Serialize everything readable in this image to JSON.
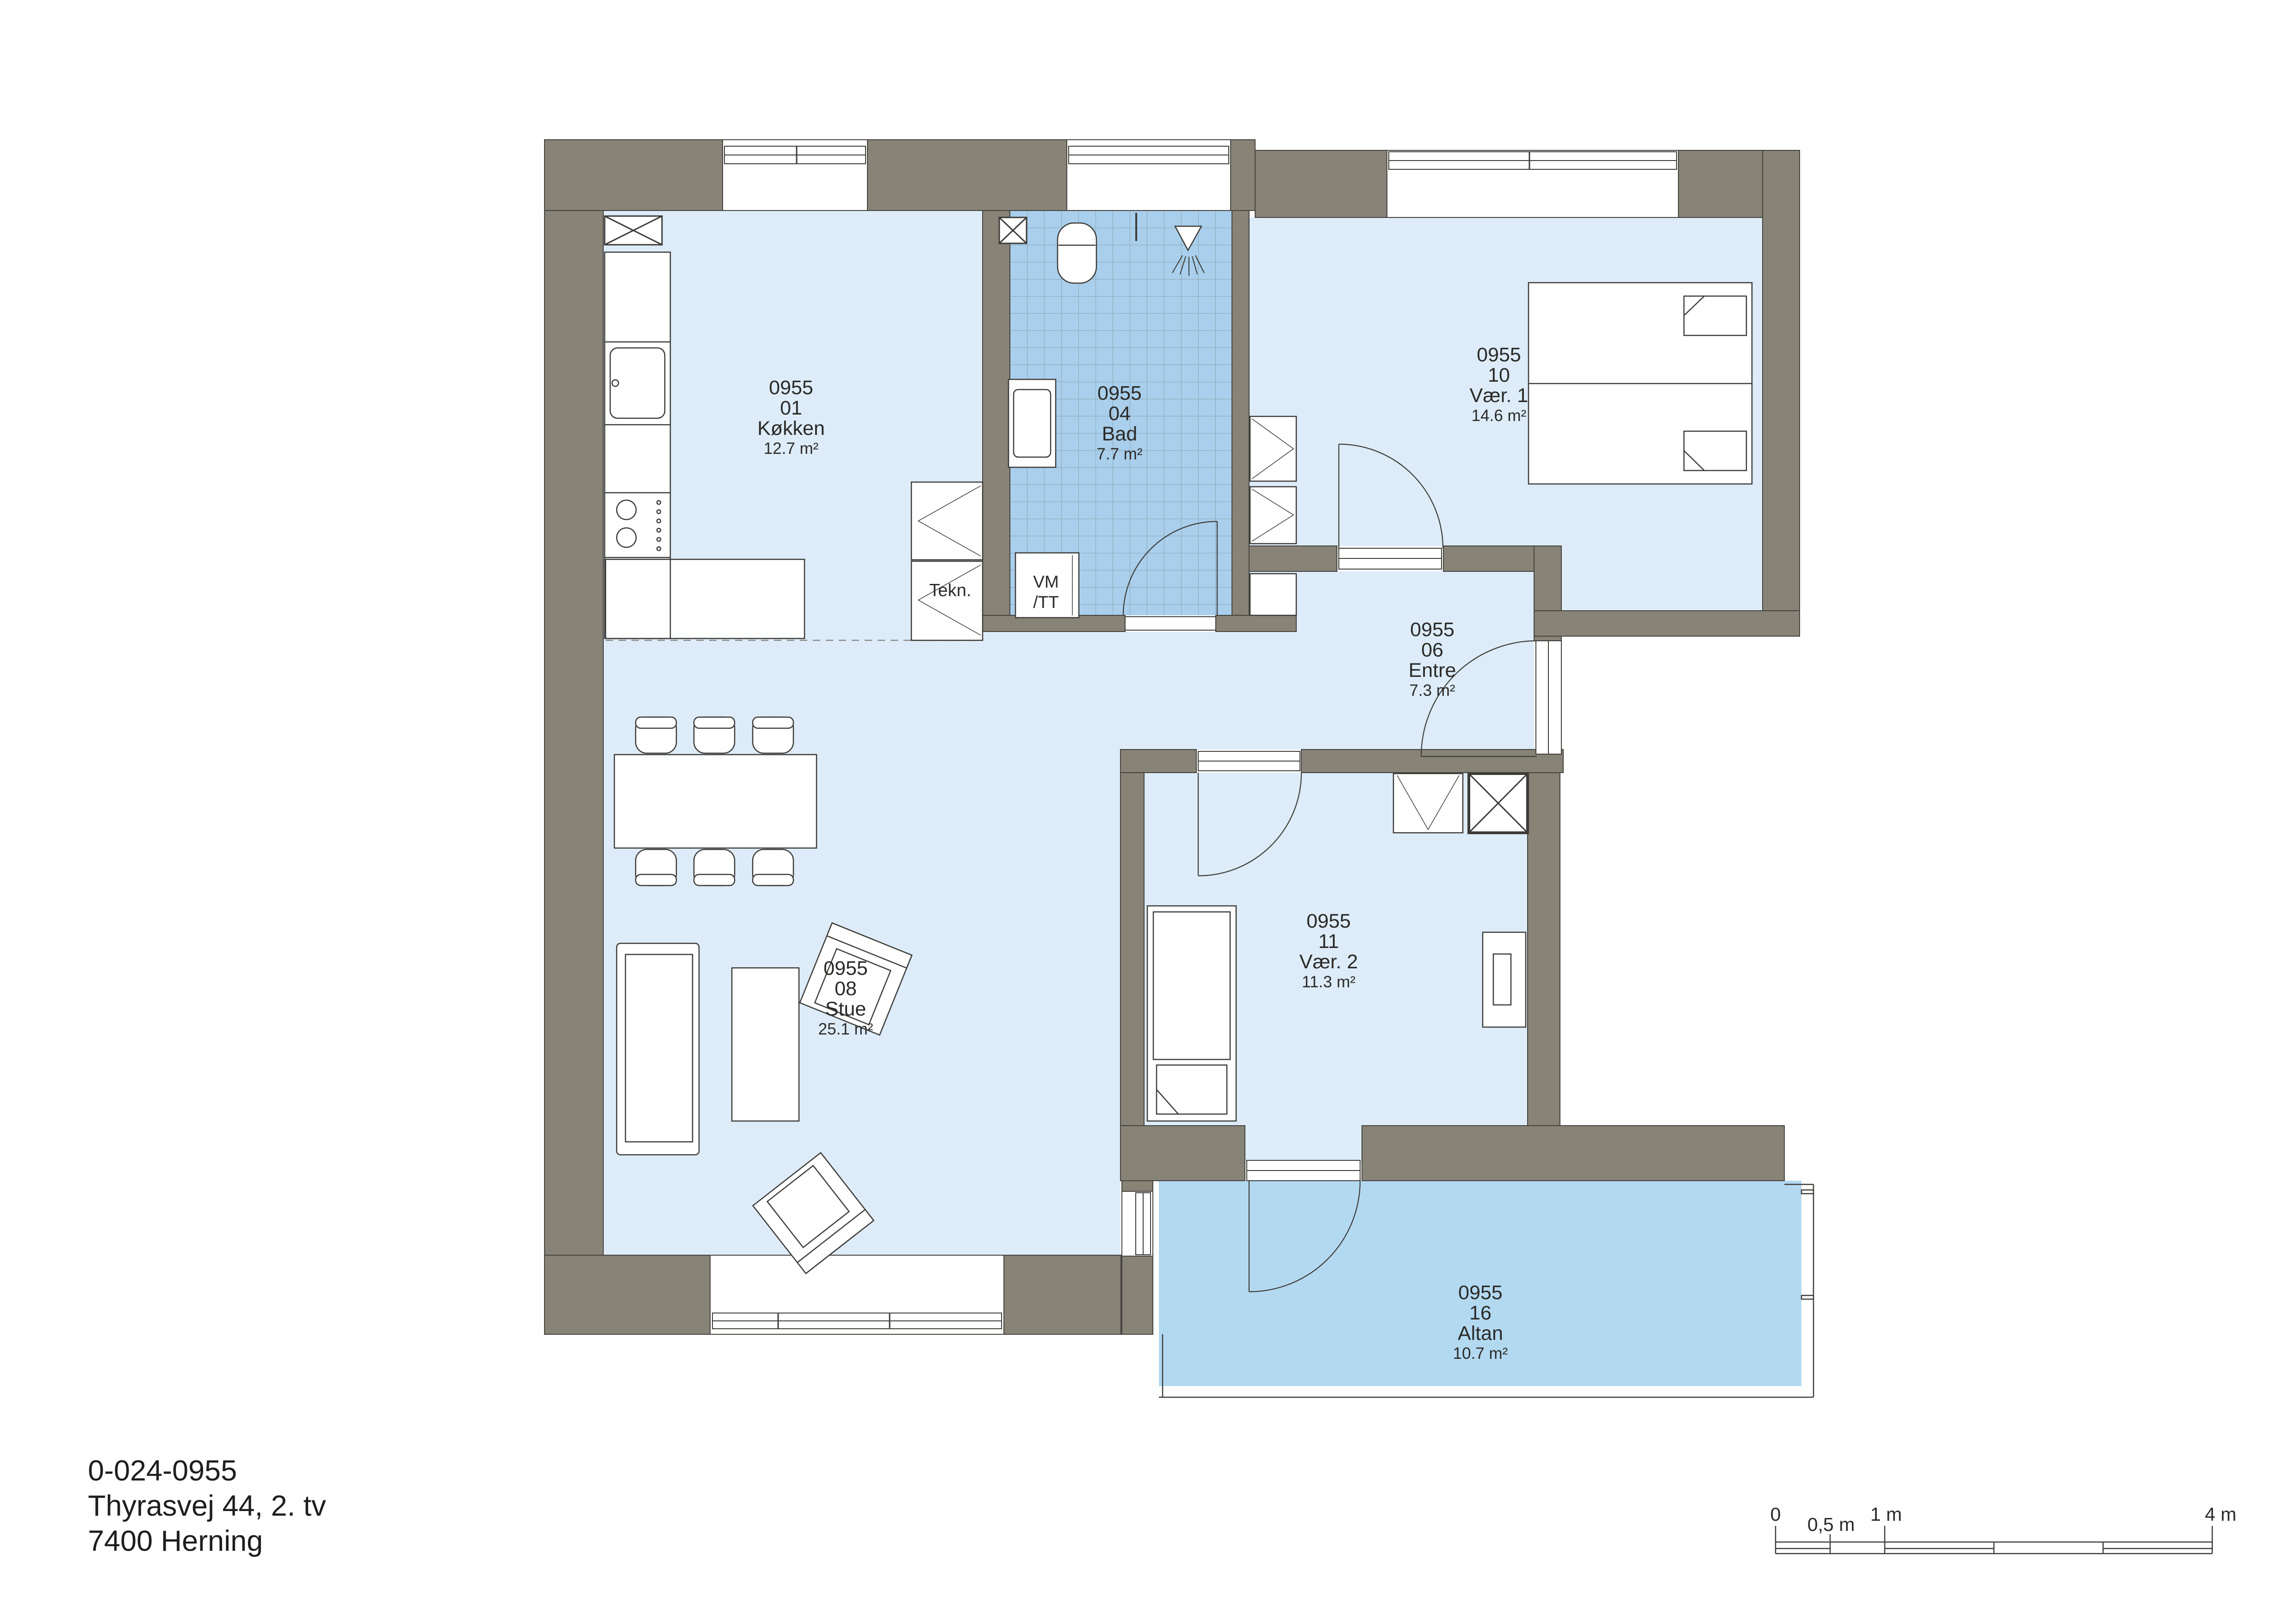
{
  "plan": {
    "rooms": [
      {
        "key": "kokken",
        "number": "0955",
        "unit": "01",
        "name": "Køkken",
        "area": "12.7 m²"
      },
      {
        "key": "bad",
        "number": "0955",
        "unit": "04",
        "name": "Bad",
        "area": "7.7 m²"
      },
      {
        "key": "var1",
        "number": "0955",
        "unit": "10",
        "name": "Vær. 1",
        "area": "14.6 m²"
      },
      {
        "key": "entre",
        "number": "0955",
        "unit": "06",
        "name": "Entre",
        "area": "7.3 m²"
      },
      {
        "key": "var2",
        "number": "0955",
        "unit": "11",
        "name": "Vær. 2",
        "area": "11.3 m²"
      },
      {
        "key": "stue",
        "number": "0955",
        "unit": "08",
        "name": "Stue",
        "area": "25.1 m²"
      },
      {
        "key": "altan",
        "number": "0955",
        "unit": "16",
        "name": "Altan",
        "area": "10.7 m²"
      }
    ],
    "annotations": {
      "tekn": "Tekn.",
      "vm": "VM",
      "tt": "/TT"
    }
  },
  "footer": {
    "plan_id": "0-024-0955",
    "address": "Thyrasvej 44, 2. tv",
    "city": "7400 Herning"
  },
  "scale_bar": {
    "ticks": [
      "0",
      "0,5 m",
      "1 m",
      "4 m"
    ]
  },
  "colors": {
    "wall": "#878377",
    "room_fill": "#ddecf8",
    "tile_fill": "#a9cfec",
    "balcony_fill": "#b3d9f1",
    "line": "#3e3c38"
  }
}
